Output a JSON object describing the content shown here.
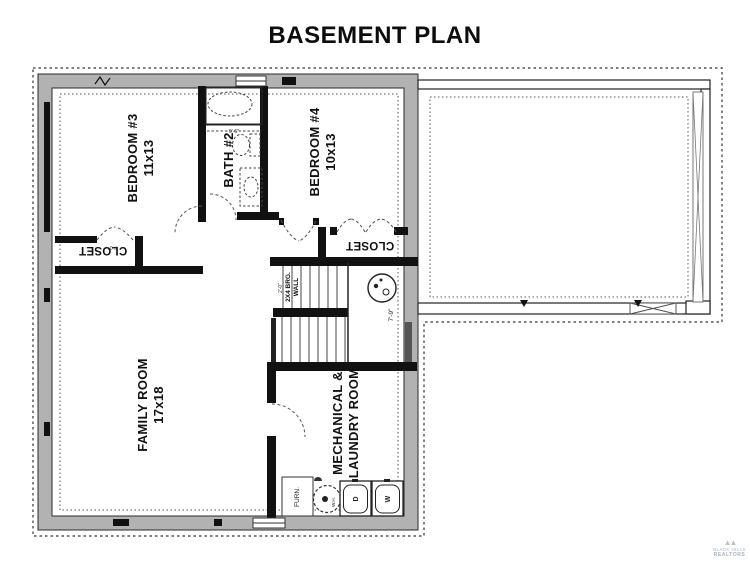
{
  "title": "BASEMENT PLAN",
  "rooms": {
    "bedroom3": {
      "name": "BEDROOM #3",
      "size": "11x13"
    },
    "bath2": {
      "name": "BATH #2"
    },
    "bedroom4": {
      "name": "BEDROOM #4",
      "size": "10x13"
    },
    "closet_left": {
      "name": "CLOSET"
    },
    "closet_right": {
      "name": "CLOSET"
    },
    "family_room": {
      "name": "FAMILY ROOM",
      "size": "17x18"
    },
    "mechanical": {
      "line1": "MECHANICAL &",
      "line2": "LAUNDRY ROOM"
    }
  },
  "fixtures": {
    "furnace": "FURN.",
    "water_heater": "W.H.",
    "dryer": "D",
    "washer": "W"
  },
  "annotations": {
    "bearing_wall_line1": "2X4 BRG.",
    "bearing_wall_line2": "WALL",
    "stair_width": "7'-9\"",
    "closet_door_width": "4'-0\"",
    "stair_offset": "2'-0\"",
    "tub_dim": "0'-6\""
  },
  "footer_logo": {
    "mark": "▲▲",
    "line1": "BLACK HILLS",
    "line2": "REALTORS"
  },
  "colors": {
    "wall_gray": "#b2b2b2",
    "line": "#222222",
    "dash": "#444444"
  }
}
